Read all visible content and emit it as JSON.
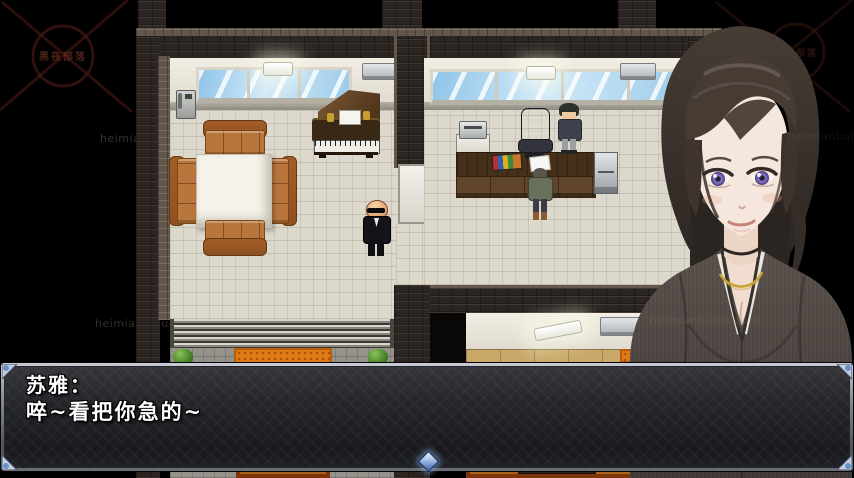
{
  "dialogue": {
    "speaker_name": "苏雅：",
    "line": "啐~看把你急的~"
  },
  "watermarks": {
    "corner_stamp_text": "黑夜部落",
    "site_text": "heimianbuluo.com"
  },
  "colors": {
    "dialog_frame_silver": "#aab0b8",
    "ornament_blue": "#6890c8",
    "carpet_red": "#9a4614",
    "doormat_orange": "#e07a16",
    "couch_leather": "#b9763c",
    "window_glass": "#aed6f0",
    "portrait_suit_gray": "#57504b",
    "portrait_eye_purple": "#7a6ab8",
    "necklace_gold": "#c9a233"
  }
}
